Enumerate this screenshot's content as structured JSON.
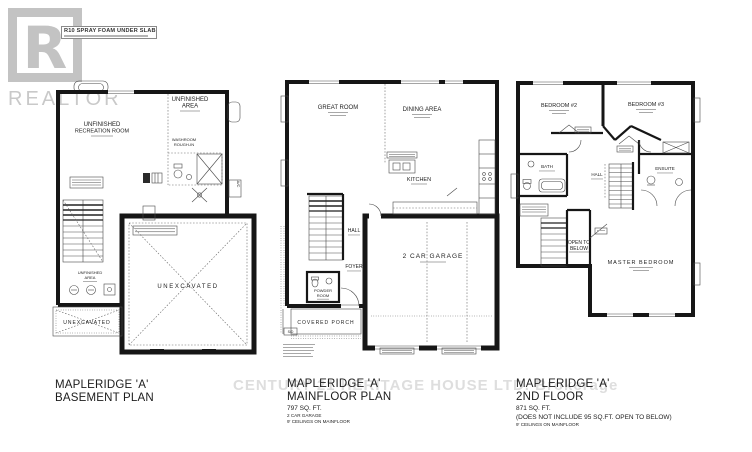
{
  "colors": {
    "ink": "#161616",
    "watermark_gray": "#c9c9c9",
    "brokerage_gray": "#dedede"
  },
  "watermarks": {
    "logo_letter": "R",
    "logo_word": "REALTOR",
    "brokerage": "CENTURY 21 HERITAGE HOUSE LTD. Brokerage"
  },
  "slab_note": {
    "line1": "R10 SPRAY FOAM UNDER SLAB"
  },
  "plans": {
    "basement": {
      "title1": "MAPLERIDGE 'A'",
      "title2": "BASEMENT PLAN",
      "labels": {
        "unf_top1": "UNFINISHED",
        "unf_top2": "AREA",
        "rec1": "UNFINISHED",
        "rec2": "RECREATION ROOM",
        "wash1": "WASHROOM",
        "wash2": "ROUGH-IN",
        "unf_small1": "UNFINISHED",
        "unf_small2": "AREA",
        "unex_small": "UNEXCAVATED",
        "unex_large": "UNEXCAVATED",
        "ac": "A/C"
      }
    },
    "mainfloor": {
      "title1": "MAPLERIDGE 'A'",
      "title2": "MAINFLOOR PLAN",
      "d1": "797 SQ. FT.",
      "d2": "2 CAR GARAGE",
      "d3": "9' CEILINGS ON MAINFLOOR",
      "labels": {
        "great_room": "GREAT ROOM",
        "dining": "DINING AREA",
        "kitchen": "KITCHEN",
        "hall": "HALL",
        "powder1": "POWDER",
        "powder2": "ROOM",
        "foyer": "FOYER",
        "porch": "COVERED PORCH",
        "garage": "2 CAR GARAGE",
        "sd": "S/D"
      }
    },
    "second": {
      "title1": "MAPLERIDGE 'A'",
      "title2": "2ND FLOOR",
      "d1": "871 SQ. FT.",
      "d2": "(DOES NOT INCLUDE 95 SQ.FT. OPEN TO BELOW)",
      "d3": "9' CEILINGS ON MAINFLOOR",
      "labels": {
        "bed2": "BEDROOM #2",
        "bed3": "BEDROOM #3",
        "bath": "BATH",
        "hall": "HALL",
        "ensuite": "ENSUITE",
        "open1": "OPEN TO",
        "open2": "BELOW",
        "master": "MASTER BEDROOM"
      }
    }
  }
}
